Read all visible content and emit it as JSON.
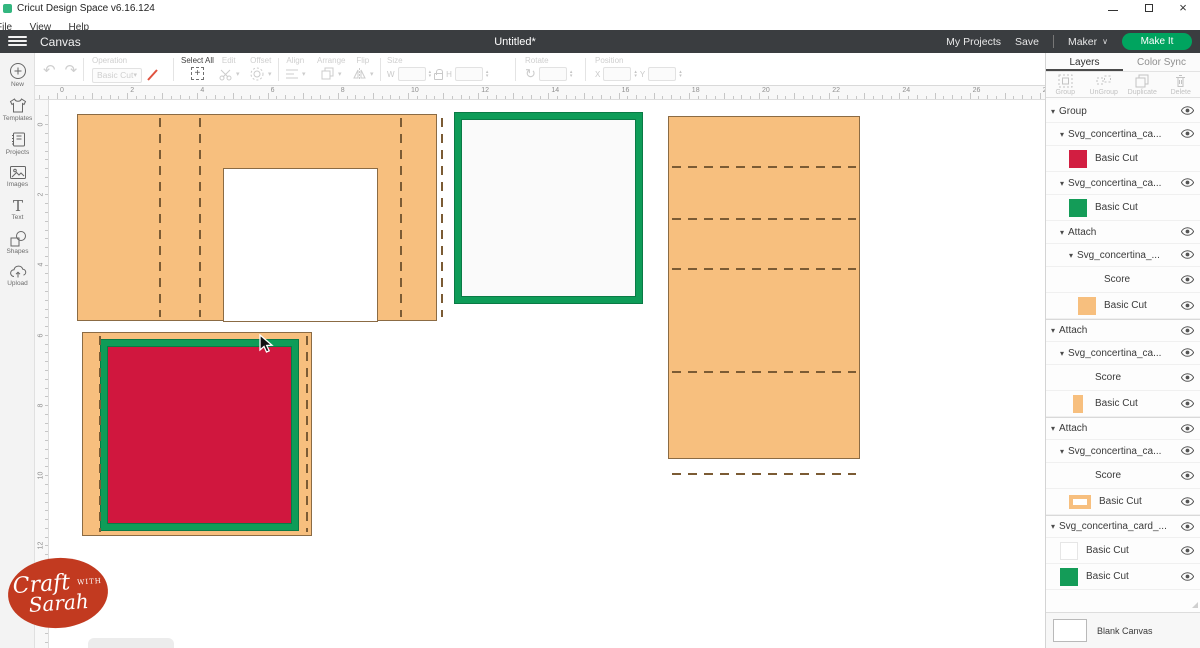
{
  "titlebar": {
    "app_title": "Cricut Design Space  v6.16.124"
  },
  "menubar": {
    "items": [
      "File",
      "View",
      "Help"
    ]
  },
  "header": {
    "canvas_label": "Canvas",
    "document_title": "Untitled*",
    "my_projects": "My Projects",
    "save": "Save",
    "machine": "Maker",
    "make_it": "Make It"
  },
  "toolbar": {
    "operation": {
      "label": "Operation",
      "value": "Basic Cut"
    },
    "select_all": "Select All",
    "edit": "Edit",
    "offset": "Offset",
    "align": "Align",
    "arrange": "Arrange",
    "flip": "Flip",
    "size": {
      "label": "Size",
      "w": "W",
      "h": "H"
    },
    "rotate": {
      "label": "Rotate"
    },
    "position": {
      "label": "Position",
      "x": "X",
      "y": "Y"
    }
  },
  "sidebar": {
    "items": [
      {
        "id": "new",
        "label": "New"
      },
      {
        "id": "templates",
        "label": "Templates"
      },
      {
        "id": "projects",
        "label": "Projects"
      },
      {
        "id": "images",
        "label": "Images"
      },
      {
        "id": "text",
        "label": "Text"
      },
      {
        "id": "shapes",
        "label": "Shapes"
      },
      {
        "id": "upload",
        "label": "Upload"
      }
    ]
  },
  "rulers": {
    "unit_px": 35.1,
    "h_origin": 22,
    "h_numbers": [
      0,
      2,
      4,
      6,
      8,
      10,
      12,
      14,
      16,
      18,
      20,
      22,
      24,
      26,
      28
    ],
    "v_origin": 19,
    "v_numbers": [
      0,
      2,
      4,
      6,
      8,
      10,
      12,
      14
    ]
  },
  "canvas": {
    "shape1": {
      "x": 42,
      "y": 28,
      "w": 360,
      "h": 207,
      "hole": {
        "x": 145,
        "y": 53,
        "w": 155,
        "h": 154
      },
      "vlines": [
        81,
        121,
        322,
        363
      ]
    },
    "shape2": {
      "x": 420,
      "y": 27,
      "w": 187,
      "h": 190
    },
    "shape3": {
      "x": 633,
      "y": 30,
      "w": 192,
      "h": 343,
      "hlines": [
        49,
        101,
        151,
        254,
        356
      ]
    },
    "shape4": {
      "x": 47,
      "y": 246,
      "w": 230,
      "h": 204,
      "vlines": [
        16,
        223
      ],
      "frame": {
        "x": 18,
        "y": 7,
        "w": 197,
        "h": 190
      }
    },
    "cursor": {
      "x": 223,
      "y": 248
    }
  },
  "layers_panel": {
    "tabs": {
      "layers": "Layers",
      "color_sync": "Color Sync"
    },
    "actions": [
      "Group",
      "UnGroup",
      "Duplicate",
      "Delete"
    ],
    "rows": [
      {
        "label": "Group",
        "caret": true,
        "indent": 0,
        "eye": true,
        "sep": false
      },
      {
        "label": "Svg_concertina_ca...",
        "caret": true,
        "indent": 1,
        "eye": true,
        "sep": false
      },
      {
        "label": "Basic Cut",
        "swatch": "red",
        "indent": 2,
        "eye": false,
        "sep": false
      },
      {
        "label": "Svg_concertina_ca...",
        "caret": true,
        "indent": 1,
        "eye": true,
        "sep": false
      },
      {
        "label": "Basic Cut",
        "swatch": "green",
        "indent": 2,
        "eye": false,
        "sep": false
      },
      {
        "label": "Attach",
        "caret": true,
        "indent": 1,
        "eye": true,
        "sep": false
      },
      {
        "label": "Svg_concertina_...",
        "caret": true,
        "indent": 2,
        "eye": true,
        "sep": false
      },
      {
        "label": "Score",
        "swatch": "blank",
        "indent": 3,
        "eye": true,
        "sep": false
      },
      {
        "label": "Basic Cut",
        "swatch": "orange",
        "indent": 3,
        "eye": true,
        "sep": false
      },
      {
        "label": "Attach",
        "caret": true,
        "indent": 0,
        "eye": true,
        "sep": true
      },
      {
        "label": "Svg_concertina_ca...",
        "caret": true,
        "indent": 1,
        "eye": true,
        "sep": false
      },
      {
        "label": "Score",
        "swatch": "blank",
        "indent": 2,
        "eye": true,
        "sep": false
      },
      {
        "label": "Basic Cut",
        "swatch": "orange-narrow",
        "indent": 2,
        "eye": true,
        "sep": false
      },
      {
        "label": "Attach",
        "caret": true,
        "indent": 0,
        "eye": true,
        "sep": true
      },
      {
        "label": "Svg_concertina_ca...",
        "caret": true,
        "indent": 1,
        "eye": true,
        "sep": false
      },
      {
        "label": "Score",
        "swatch": "blank",
        "indent": 2,
        "eye": true,
        "sep": false
      },
      {
        "label": "Basic Cut",
        "swatch": "orange-frame",
        "indent": 2,
        "eye": true,
        "sep": false
      },
      {
        "label": "Svg_concertina_card_...",
        "caret": true,
        "indent": 0,
        "eye": true,
        "sep": true
      },
      {
        "label": "Basic Cut",
        "swatch": "white",
        "indent": 1,
        "eye": true,
        "sep": false
      },
      {
        "label": "Basic Cut",
        "swatch": "green",
        "indent": 1,
        "eye": true,
        "sep": false
      }
    ],
    "blank_canvas": "Blank Canvas"
  },
  "logo": {
    "top": "Craft",
    "mid": "WITH",
    "bottom": "Sarah"
  },
  "colors": {
    "headerDark": "#3a3d40",
    "cricutGreen": "#00a45f",
    "orange": "#f7bf7e",
    "orangeBorder": "#8b6b44",
    "dash": "#7b5b34",
    "red": "#d0173e",
    "green": "#0e9c58",
    "greenDark": "#0a7a45",
    "swatchRed": "#d21e41",
    "swatchGreen": "#149c58",
    "logoRed": "#c23a20"
  }
}
